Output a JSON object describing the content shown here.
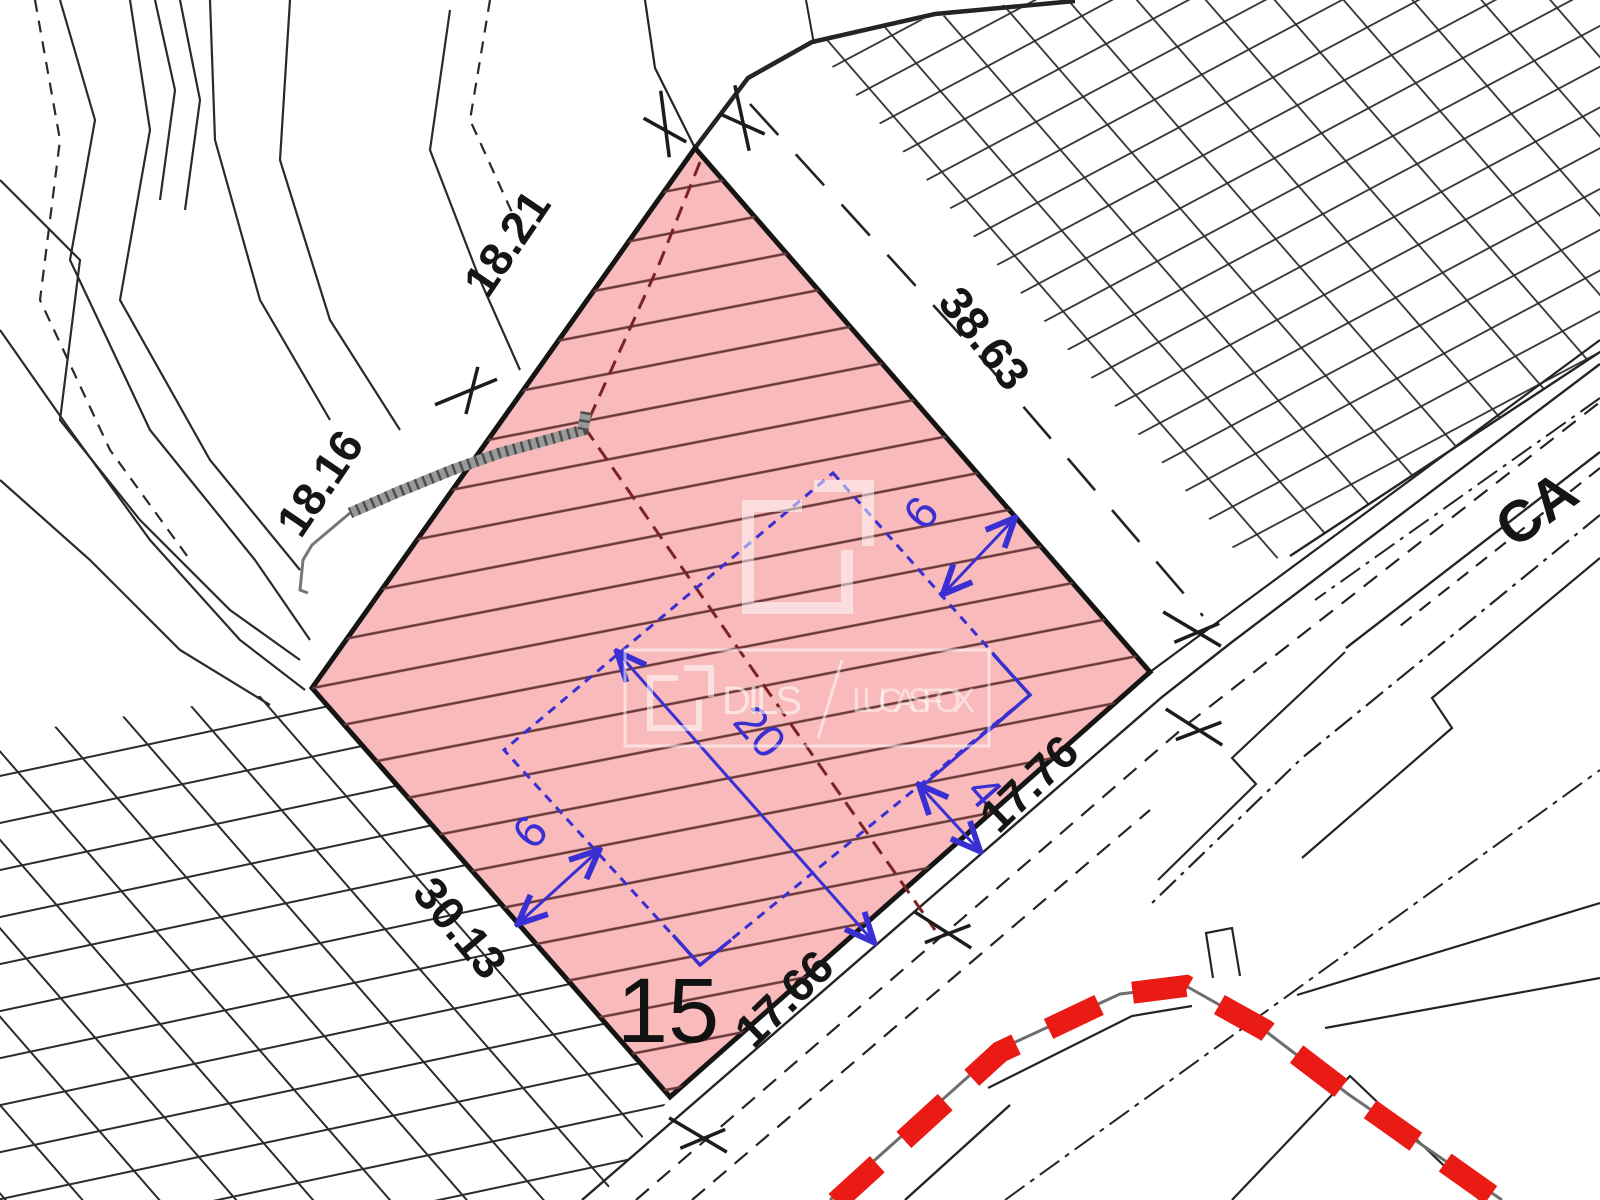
{
  "document": {
    "type": "cadastral site plan"
  },
  "plot": {
    "number": "15"
  },
  "dimensions": {
    "edge_nw_upper": "18.21",
    "edge_nw_lower": "18.16",
    "edge_ne": "38.63",
    "edge_sw": "30.13",
    "road_lower": "17.66",
    "road_upper": "17.76"
  },
  "envelope": {
    "length": "20",
    "setback_ne": "6",
    "setback_sw": "6",
    "setback_se": "4"
  },
  "street": {
    "name_partial": "CA"
  },
  "watermark": {
    "icon": "dils-logo",
    "left": "DILS",
    "separator": "/",
    "right": "LUCAS FOX"
  },
  "colors": {
    "plot_fill": "#f8baba",
    "plot_contour": "#6a3a3a",
    "envelope_blue": "#392fd2",
    "boundary_red": "#ea1a15",
    "line_black": "#242424",
    "wall_gray": "#999999",
    "watermark_white": "rgba(255,255,255,0.55)"
  }
}
